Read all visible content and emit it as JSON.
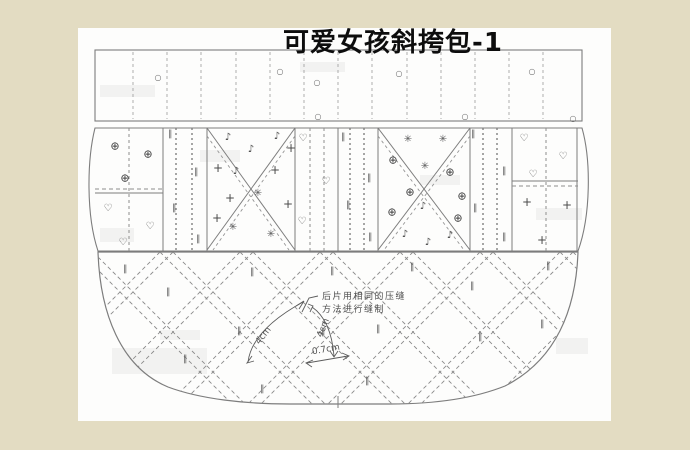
{
  "title": "可爱女孩斜挎包-1",
  "annotation": {
    "line1": "后片用相同的压缝",
    "line2": "方法进行缝制"
  },
  "measurements": {
    "seam_spacing_1": "4cm",
    "seam_spacing_2": "4cm",
    "stitch_gap": "0.7cm"
  },
  "colors": {
    "background": "#e3dcc2",
    "sheet": "#fdfdfc",
    "solid_line": "#767676",
    "dashed_line": "#8d8d8d",
    "symbol": "#4f4f4f",
    "title_text": "#0d0d0d",
    "annotation_text": "#4e4e4e"
  },
  "symbols": {
    "circle": "○",
    "crosshair": "⊕",
    "heart": "♡",
    "parallel": "∥",
    "note": "♪",
    "plus": "+",
    "flower": "✳"
  },
  "marks": [
    {
      "t": "circle",
      "x": 158,
      "y": 78
    },
    {
      "t": "circle",
      "x": 280,
      "y": 72
    },
    {
      "t": "circle",
      "x": 317,
      "y": 83
    },
    {
      "t": "circle",
      "x": 318,
      "y": 117
    },
    {
      "t": "circle",
      "x": 399,
      "y": 74
    },
    {
      "t": "circle",
      "x": 465,
      "y": 117
    },
    {
      "t": "circle",
      "x": 532,
      "y": 72
    },
    {
      "t": "circle",
      "x": 573,
      "y": 119
    },
    {
      "t": "crosshair",
      "x": 115,
      "y": 146
    },
    {
      "t": "crosshair",
      "x": 148,
      "y": 154
    },
    {
      "t": "crosshair",
      "x": 125,
      "y": 178
    },
    {
      "t": "heart",
      "x": 108,
      "y": 209
    },
    {
      "t": "heart",
      "x": 150,
      "y": 227
    },
    {
      "t": "heart",
      "x": 123,
      "y": 243
    },
    {
      "t": "parallel",
      "x": 170,
      "y": 135
    },
    {
      "t": "parallel",
      "x": 196,
      "y": 173
    },
    {
      "t": "parallel",
      "x": 174,
      "y": 209
    },
    {
      "t": "parallel",
      "x": 198,
      "y": 240
    },
    {
      "t": "note",
      "x": 228,
      "y": 138
    },
    {
      "t": "note",
      "x": 277,
      "y": 137
    },
    {
      "t": "note",
      "x": 251,
      "y": 150
    },
    {
      "t": "note",
      "x": 236,
      "y": 172
    },
    {
      "t": "plus",
      "x": 218,
      "y": 168
    },
    {
      "t": "plus",
      "x": 275,
      "y": 170
    },
    {
      "t": "plus",
      "x": 291,
      "y": 148
    },
    {
      "t": "plus",
      "x": 230,
      "y": 198
    },
    {
      "t": "plus",
      "x": 288,
      "y": 204
    },
    {
      "t": "plus",
      "x": 217,
      "y": 218
    },
    {
      "t": "flower",
      "x": 258,
      "y": 194
    },
    {
      "t": "flower",
      "x": 233,
      "y": 228
    },
    {
      "t": "flower",
      "x": 271,
      "y": 235
    },
    {
      "t": "heart",
      "x": 303,
      "y": 139
    },
    {
      "t": "heart",
      "x": 326,
      "y": 182
    },
    {
      "t": "heart",
      "x": 302,
      "y": 222
    },
    {
      "t": "parallel",
      "x": 343,
      "y": 138
    },
    {
      "t": "parallel",
      "x": 369,
      "y": 179
    },
    {
      "t": "parallel",
      "x": 348,
      "y": 206
    },
    {
      "t": "parallel",
      "x": 370,
      "y": 238
    },
    {
      "t": "crosshair",
      "x": 393,
      "y": 160
    },
    {
      "t": "crosshair",
      "x": 450,
      "y": 172
    },
    {
      "t": "crosshair",
      "x": 410,
      "y": 192
    },
    {
      "t": "crosshair",
      "x": 392,
      "y": 212
    },
    {
      "t": "crosshair",
      "x": 462,
      "y": 196
    },
    {
      "t": "crosshair",
      "x": 458,
      "y": 218
    },
    {
      "t": "flower",
      "x": 408,
      "y": 140
    },
    {
      "t": "flower",
      "x": 443,
      "y": 140
    },
    {
      "t": "flower",
      "x": 425,
      "y": 167
    },
    {
      "t": "note",
      "x": 423,
      "y": 207
    },
    {
      "t": "note",
      "x": 405,
      "y": 235
    },
    {
      "t": "note",
      "x": 428,
      "y": 243
    },
    {
      "t": "note",
      "x": 450,
      "y": 236
    },
    {
      "t": "parallel",
      "x": 473,
      "y": 135
    },
    {
      "t": "parallel",
      "x": 504,
      "y": 172
    },
    {
      "t": "parallel",
      "x": 475,
      "y": 209
    },
    {
      "t": "parallel",
      "x": 504,
      "y": 238
    },
    {
      "t": "heart",
      "x": 524,
      "y": 139
    },
    {
      "t": "heart",
      "x": 563,
      "y": 157
    },
    {
      "t": "heart",
      "x": 533,
      "y": 175
    },
    {
      "t": "plus",
      "x": 527,
      "y": 202
    },
    {
      "t": "plus",
      "x": 567,
      "y": 205
    },
    {
      "t": "plus",
      "x": 542,
      "y": 240
    },
    {
      "t": "parallel",
      "x": 125,
      "y": 270
    },
    {
      "t": "parallel",
      "x": 168,
      "y": 293
    },
    {
      "t": "parallel",
      "x": 252,
      "y": 273
    },
    {
      "t": "parallel",
      "x": 332,
      "y": 272
    },
    {
      "t": "parallel",
      "x": 412,
      "y": 268
    },
    {
      "t": "parallel",
      "x": 239,
      "y": 332
    },
    {
      "t": "parallel",
      "x": 323,
      "y": 333
    },
    {
      "t": "parallel",
      "x": 378,
      "y": 330
    },
    {
      "t": "parallel",
      "x": 472,
      "y": 287
    },
    {
      "t": "parallel",
      "x": 480,
      "y": 338
    },
    {
      "t": "parallel",
      "x": 548,
      "y": 267
    },
    {
      "t": "parallel",
      "x": 542,
      "y": 325
    },
    {
      "t": "parallel",
      "x": 185,
      "y": 360
    },
    {
      "t": "parallel",
      "x": 262,
      "y": 390
    },
    {
      "t": "parallel",
      "x": 367,
      "y": 382
    }
  ]
}
